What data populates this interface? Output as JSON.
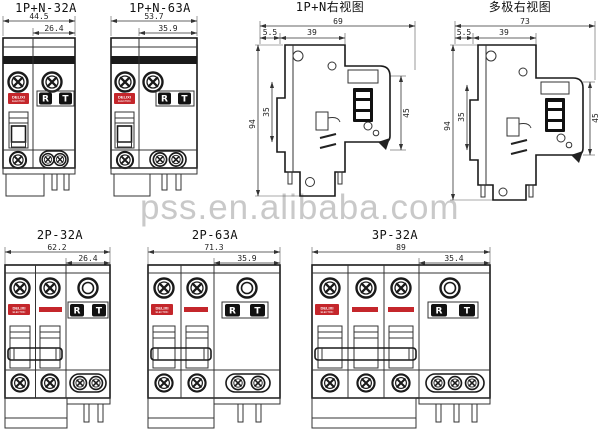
{
  "watermark": "pss.en.alibaba.com",
  "brand": {
    "logo": "DELIXI",
    "logo_sub": "ELECTRIC"
  },
  "buttons": {
    "reset": "R",
    "test": "T"
  },
  "colors": {
    "line": "#333333",
    "accent_red": "#c4262b",
    "button_black": "#111111",
    "watermark_gray": "#c9c9c9"
  },
  "views": {
    "front_1pn32": {
      "title": "1P+N-32A",
      "width_total": "44.5",
      "width_right": "26.4"
    },
    "front_1pn63": {
      "title": "1P+N-63A",
      "width_total": "53.7",
      "width_right": "35.9"
    },
    "side_1pn": {
      "title": "1P+N右视图",
      "depth_total": "69",
      "offset": "5.5",
      "depth_body": "39",
      "height_total": "94",
      "height_din": "35",
      "height_right": "45"
    },
    "side_multi": {
      "title": "多极右视图",
      "depth_total": "73",
      "offset": "5.5",
      "depth_body": "39",
      "height_total": "94",
      "height_din": "35",
      "height_right": "45"
    },
    "front_2p32": {
      "title": "2P-32A",
      "width_total": "62.2",
      "width_right": "26.4"
    },
    "front_2p63": {
      "title": "2P-63A",
      "width_total": "71.3",
      "width_right": "35.9"
    },
    "front_3p32": {
      "title": "3P-32A",
      "width_total": "89",
      "width_right": "35.4"
    }
  }
}
